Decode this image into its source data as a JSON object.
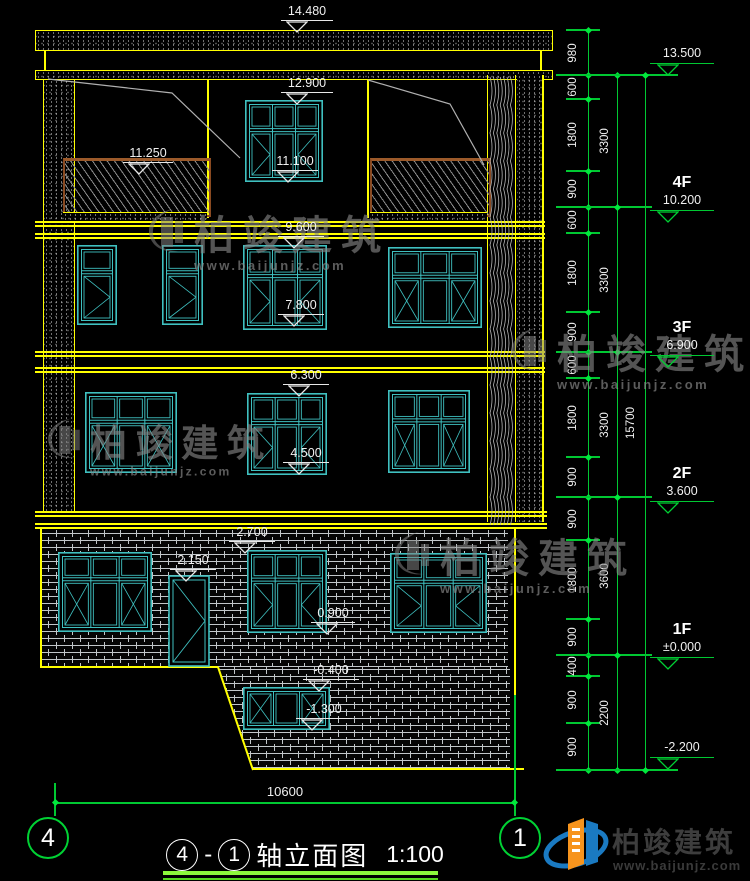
{
  "drawing_title": {
    "bubble_left": "4",
    "separator": "-",
    "bubble_right": "1",
    "name": "轴立面图",
    "scale": "1:100"
  },
  "axis_bubbles": {
    "left": "4",
    "right": "1"
  },
  "dimensions": {
    "overall_width": "10600",
    "overall_height": "15700",
    "floor_heights": [
      "3300",
      "3300",
      "3300",
      "3600",
      "2200"
    ],
    "segments": [
      "980",
      "600",
      "1800",
      "900",
      "600",
      "1800",
      "900",
      "600",
      "1800",
      "900",
      "900",
      "1800",
      "900",
      "400",
      "900",
      "900"
    ]
  },
  "left_levels": [
    "14.480",
    "12.900",
    "11.250",
    "11.100",
    "9.600",
    "7.800",
    "6.300",
    "4.500",
    "2.700",
    "2.150",
    "0.900",
    "-0.400",
    "-1.300"
  ],
  "right_levels": [
    {
      "floor": "",
      "value": "13.500"
    },
    {
      "floor": "4F",
      "value": "10.200"
    },
    {
      "floor": "3F",
      "value": "6.900"
    },
    {
      "floor": "2F",
      "value": "3.600"
    },
    {
      "floor": "1F",
      "value": "±0.000"
    },
    {
      "floor": "",
      "value": "-2.200"
    }
  ],
  "watermark": {
    "brand": "柏竣建筑",
    "site": "www.baijunjz.com"
  },
  "logo": {
    "brand": "柏竣建筑",
    "site": "www.baijunjz.com"
  },
  "colors": {
    "cad_yellow": "#ffff00",
    "cad_green": "#00c832",
    "cad_cyan": "#3fc0c0",
    "tick_green": "#00e83c",
    "railing_brown": "#9c5a2a",
    "logo_blue": "#1a7ac2",
    "logo_orange": "#f7941d"
  }
}
